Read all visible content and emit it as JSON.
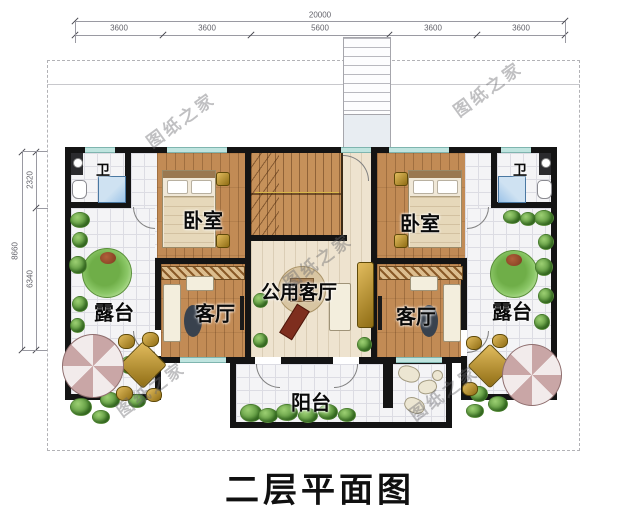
{
  "drawing": {
    "title": "二层平面图",
    "watermark": "图纸之家"
  },
  "dimensions": {
    "top": {
      "total": "20000",
      "segments": [
        "3600",
        "3600",
        "5600",
        "3600",
        "3600"
      ]
    },
    "left": {
      "total": "8660",
      "segments": [
        "2320",
        "6340"
      ]
    }
  },
  "rooms": {
    "bathroom_left": "卫",
    "bathroom_right": "卫",
    "bedroom_left": "卧室",
    "bedroom_right": "卧室",
    "living_left": "客厅",
    "living_right": "客厅",
    "shared_living": "公用客厅",
    "terrace_left": "露台",
    "terrace_right": "露台",
    "balcony": "阳台"
  },
  "colors": {
    "wall": "#141414",
    "wood_floor": "#c28b55",
    "tile_floor": "#f4f4f6",
    "window_glass": "#bfe4df",
    "plant_green": "#4d8a32",
    "shower_blue": "#9cc3e8",
    "title_text": "#101010"
  }
}
